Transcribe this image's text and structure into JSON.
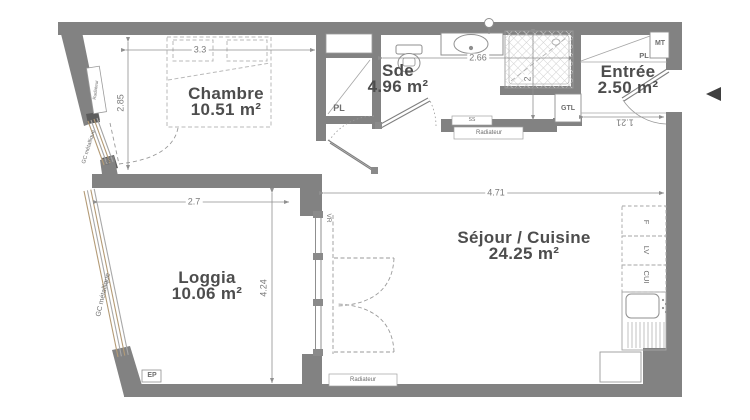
{
  "rooms": {
    "chambre": {
      "name": "Chambre",
      "area": "10.51 m²"
    },
    "sde": {
      "name": "Sde",
      "area": "4.96 m²"
    },
    "entree": {
      "name": "Entrée",
      "area": "2.50 m²"
    },
    "sejour": {
      "name": "Séjour / Cuisine",
      "area": "24.25 m²"
    },
    "loggia": {
      "name": "Loggia",
      "area": "10.06 m²"
    }
  },
  "dimensions": {
    "chambre_width": "3.3",
    "chambre_depth": "2.85",
    "sde_width": "2.66",
    "shower_depth": "2",
    "entree_width": "1.21",
    "sejour_width": "4.71",
    "loggia_width": "2.7",
    "loggia_depth": "4.24"
  },
  "labels": {
    "radiateur": "Radiateur",
    "pl": "PL",
    "mt": "MT",
    "gtl": "GTL",
    "vr": "VR",
    "ep": "EP",
    "ss": "SS",
    "gc_metallique": "GC métallique",
    "fridge": "F",
    "dishwasher": "LV",
    "cooker": "CUI"
  },
  "colors": {
    "wall": "#828282",
    "thin_line": "#8f8f8f",
    "room_text": "#4d4d4d",
    "dim_text": "#7a7a7a",
    "railing": "#b49b76",
    "hatch": "#cccccc",
    "entrance_arrow": "#3f3f3f"
  }
}
